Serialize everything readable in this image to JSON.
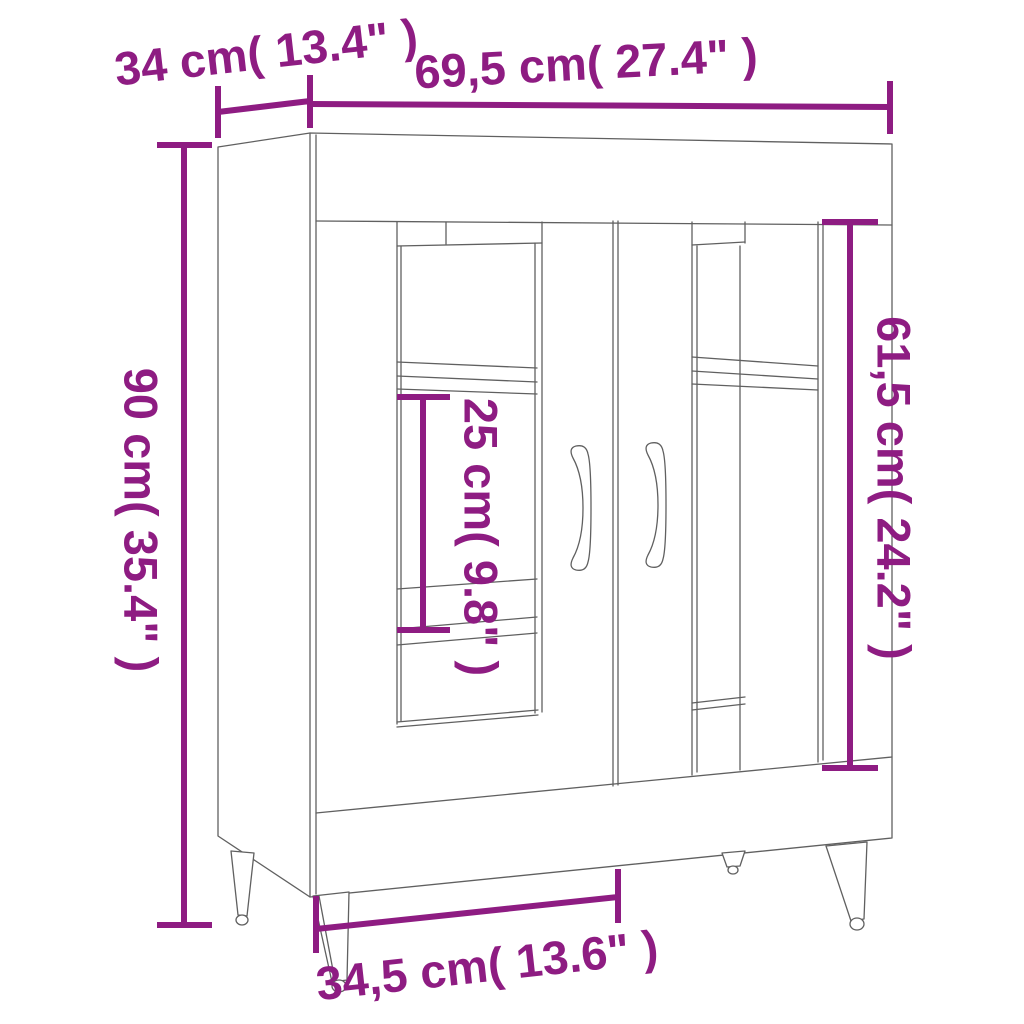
{
  "style": {
    "dimension_color": "#8e1c82",
    "outline_color": "#606060",
    "background": "#ffffff"
  },
  "dimensions": {
    "depth": {
      "label": "34 cm( 13.4\" )",
      "cm": "34",
      "inches": "13.4"
    },
    "width": {
      "label": "69,5 cm( 27.4\" )",
      "cm": "69,5",
      "inches": "27.4"
    },
    "height": {
      "label": "90 cm( 35.4\" )",
      "cm": "90",
      "inches": "35.4"
    },
    "shelf_spacing": {
      "label": "25 cm( 9.8\" )",
      "cm": "25",
      "inches": "9.8"
    },
    "interior_height": {
      "label": "61,5 cm( 24.2\" )",
      "cm": "61,5",
      "inches": "24.2"
    },
    "compartment_width": {
      "label": "34,5 cm( 13.6\" )",
      "cm": "34,5",
      "inches": "13.6"
    }
  }
}
